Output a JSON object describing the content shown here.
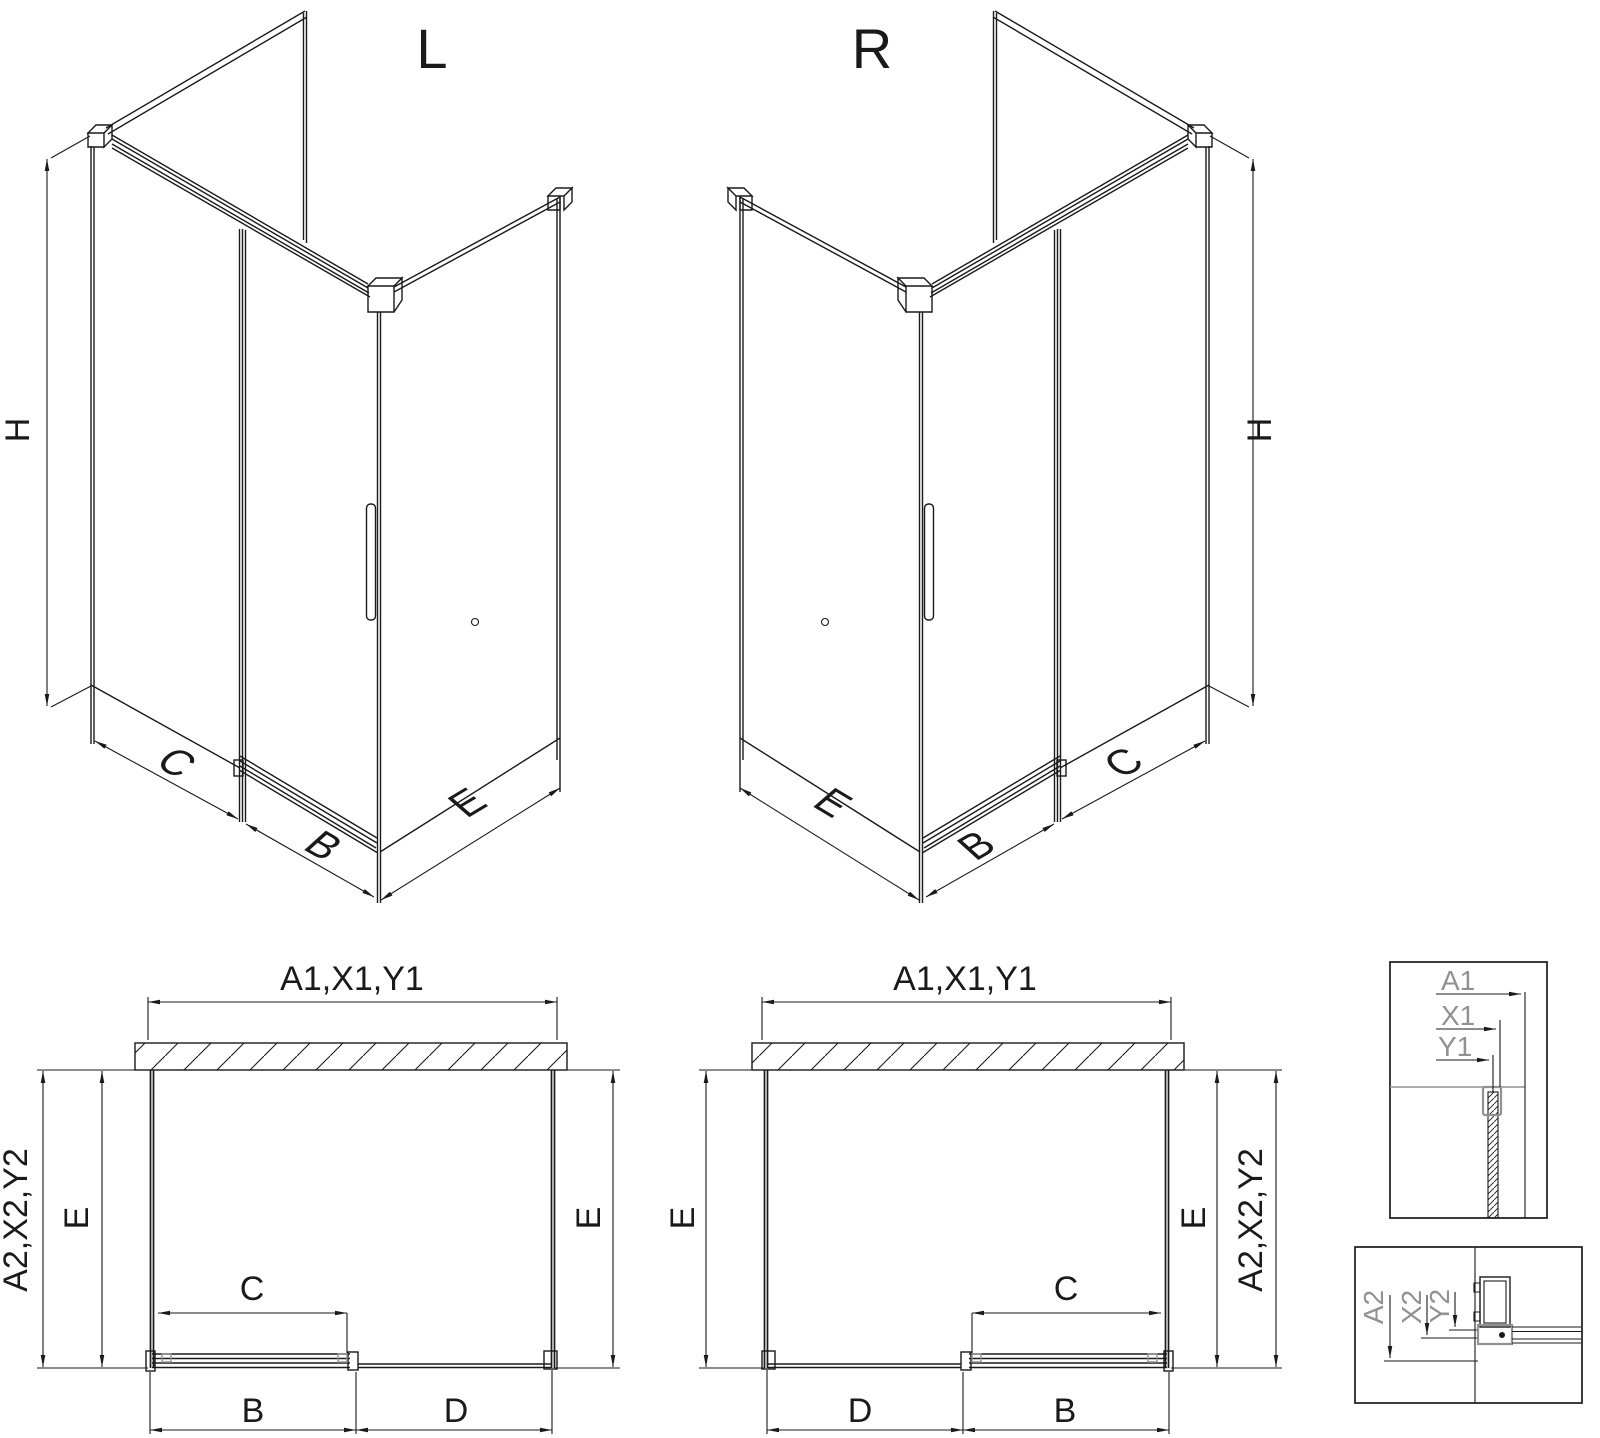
{
  "diagram": {
    "views": {
      "iso_left": {
        "title": "L",
        "height_label": "H",
        "fixed_label": "C",
        "door_label": "B",
        "panel_label": "E"
      },
      "iso_right": {
        "title": "R",
        "height_label": "H",
        "fixed_label": "C",
        "door_label": "B",
        "panel_label": "E"
      },
      "plan_left": {
        "width_label": "A1,X1,Y1",
        "depth_outer_label": "A2,X2,Y2",
        "depth_left_label": "E",
        "depth_right_label": "E",
        "opening_label": "C",
        "door_label": "B",
        "fixed_label": "D"
      },
      "plan_right": {
        "width_label": "A1,X1,Y1",
        "depth_outer_label": "A2,X2,Y2",
        "depth_left_label": "E",
        "depth_right_label": "E",
        "opening_label": "C",
        "door_label": "B",
        "fixed_label": "D"
      },
      "detail_top": {
        "dim_a": "A1",
        "dim_x": "X1",
        "dim_y": "Y1"
      },
      "detail_bottom": {
        "dim_a": "A2",
        "dim_x": "X2",
        "dim_y": "Y2"
      }
    },
    "colors": {
      "line": "#1a1a1a",
      "detail_gray": "#8f9193",
      "background": "#ffffff"
    }
  }
}
